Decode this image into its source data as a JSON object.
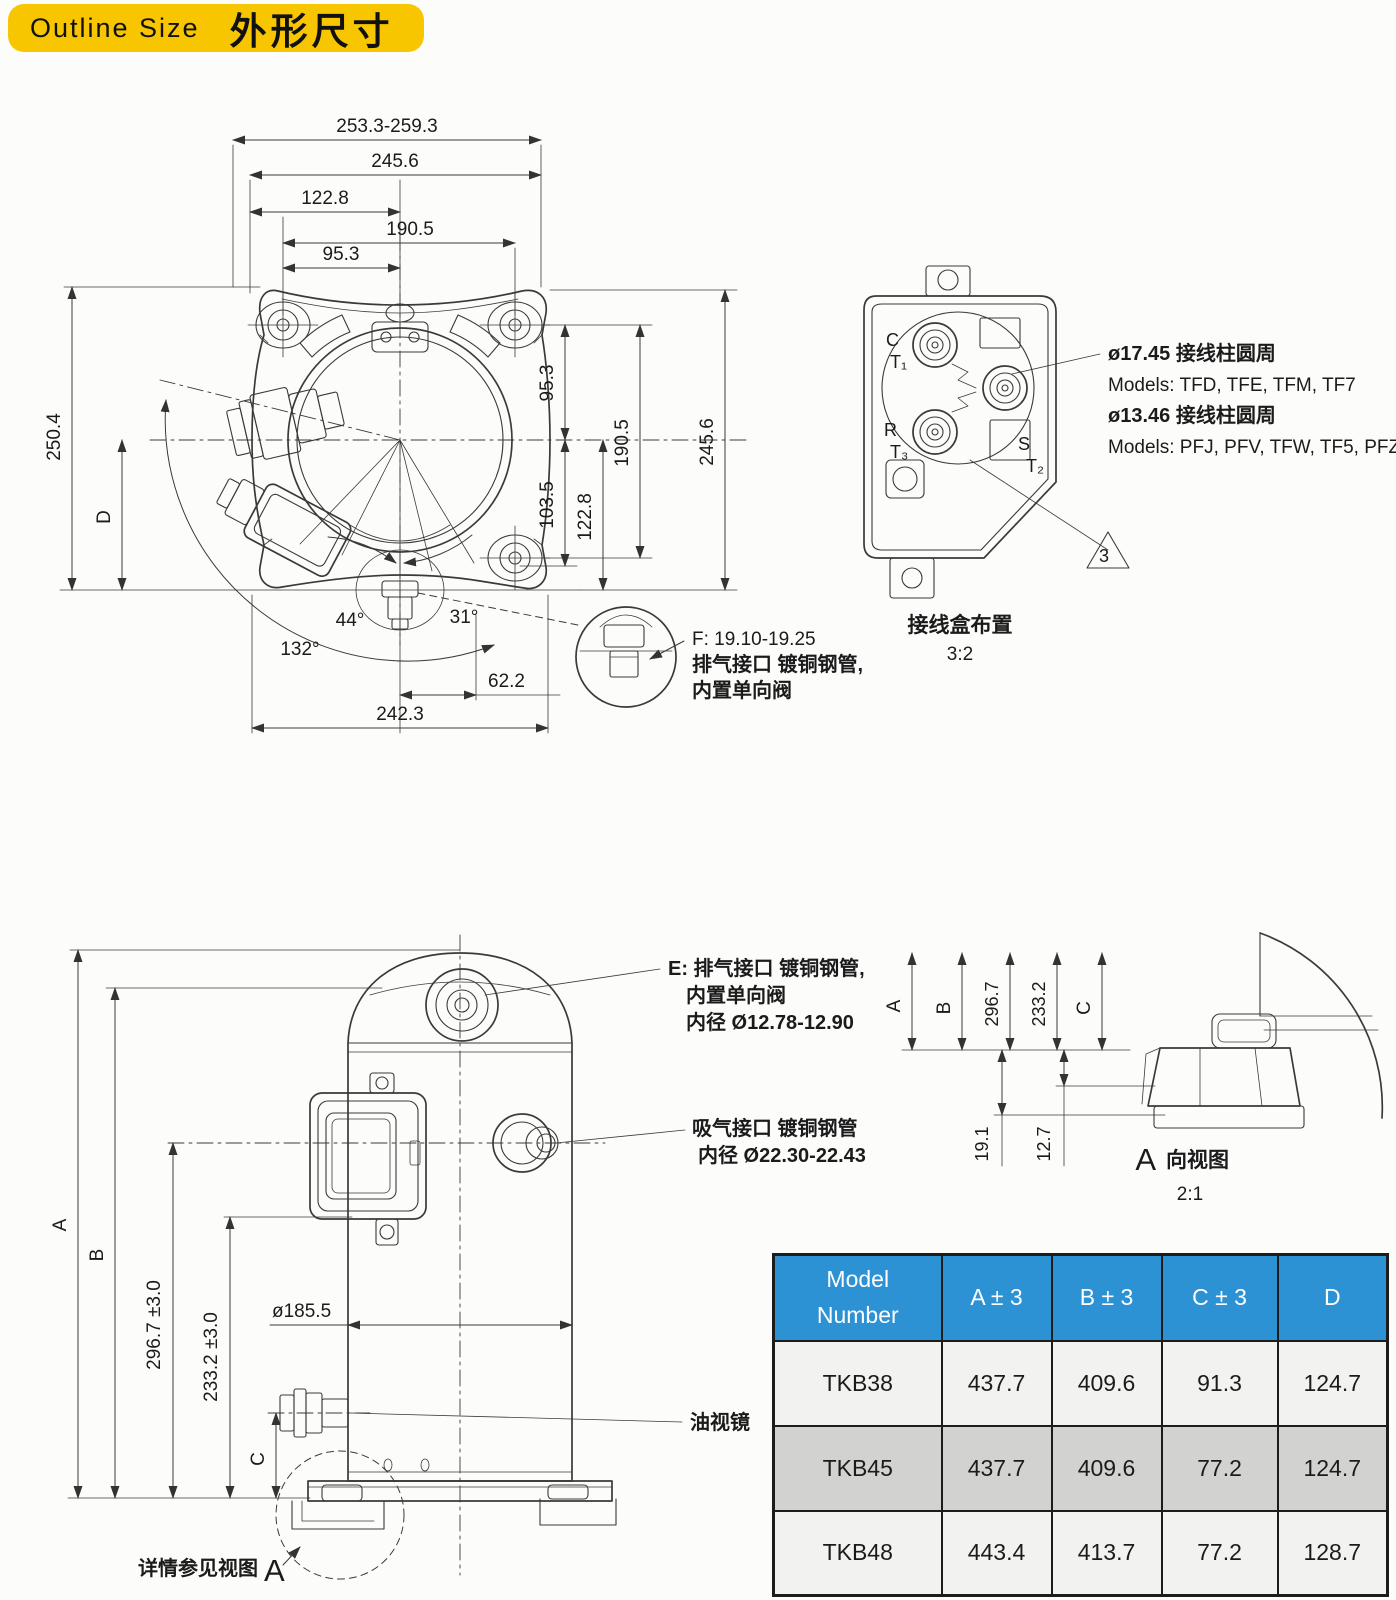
{
  "theme": {
    "title-bg": "#F8C600",
    "table-header-bg": "#2C92D3",
    "table-header-fg": "#FFFFFF",
    "row-light": "#F2F2F0",
    "row-dark": "#D2D2D0",
    "line": "#3A3A3A"
  },
  "title": {
    "en": "Outline Size",
    "zh": "外形尺寸"
  },
  "top_view": {
    "dim_overall_width": "253.3-259.3",
    "dim_plate_width": "245.6",
    "dim_left_to_center": "122.8",
    "dim_bolt_span_h": "190.5",
    "dim_bolt_half_h": "95.3",
    "dim_overall_height": "250.4",
    "dim_d": "D",
    "dim_bolt_half_v": "95.3",
    "dim_103_5": "103.5",
    "dim_122_8_right": "122.8",
    "dim_bolt_span_v": "190.5",
    "dim_plate_height": "245.6",
    "angle_44": "44°",
    "angle_31": "31°",
    "angle_132": "132°",
    "dim_62_2": "62.2",
    "dim_242_3": "242.3",
    "detail_f_line1": "F: 19.10-19.25",
    "detail_f_line2": "排气接口 镀铜钢管,",
    "detail_f_line3": "内置单向阀"
  },
  "terminal_box": {
    "label_c": "C",
    "label_t1": "T₁",
    "label_r": "R",
    "label_t3": "T₃",
    "label_s": "S",
    "label_t2": "T₂",
    "note_line1": "ø17.45 接线柱圆周",
    "note_line2": "Models: TFD, TFE, TFM, TF7",
    "note_line3": "ø13.46 接线柱圆周",
    "note_line4": "Models: PFJ, PFV, TFW, TF5, PFZ",
    "flag": "3",
    "caption": "接线盒布置",
    "scale": "3:2"
  },
  "side_view": {
    "note_e_line1": "E: 排气接口 镀铜钢管,",
    "note_e_line2": "内置单向阀",
    "note_e_line3": "内径 Ø12.78-12.90",
    "note_suction_line1": "吸气接口 镀铜钢管",
    "note_suction_line2": "内径 Ø22.30-22.43",
    "dim_a": "A",
    "dim_b": "B",
    "dim_296": "296.7 ±3.0",
    "dim_233": "233.2 ±3.0",
    "dim_c": "C",
    "dim_diameter": "ø185.5",
    "oil_sight": "油视镜",
    "detail_ref": "详情参见视图",
    "detail_ref_letter": "A"
  },
  "a_view": {
    "dim_a": "A",
    "dim_b": "B",
    "dim_296": "296.7",
    "dim_233": "233.2",
    "dim_c": "C",
    "dim_19_1": "19.1",
    "dim_12_7": "12.7",
    "caption_letter": "A",
    "caption": "向视图",
    "scale": "2:1"
  },
  "table": {
    "headers": [
      "Model\nNumber",
      "A ± 3",
      "B ± 3",
      "C ± 3",
      "D"
    ],
    "rows": [
      [
        "TKB38",
        "437.7",
        "409.6",
        "91.3",
        "124.7"
      ],
      [
        "TKB45",
        "437.7",
        "409.6",
        "77.2",
        "124.7"
      ],
      [
        "TKB48",
        "443.4",
        "413.7",
        "77.2",
        "128.7"
      ]
    ]
  }
}
